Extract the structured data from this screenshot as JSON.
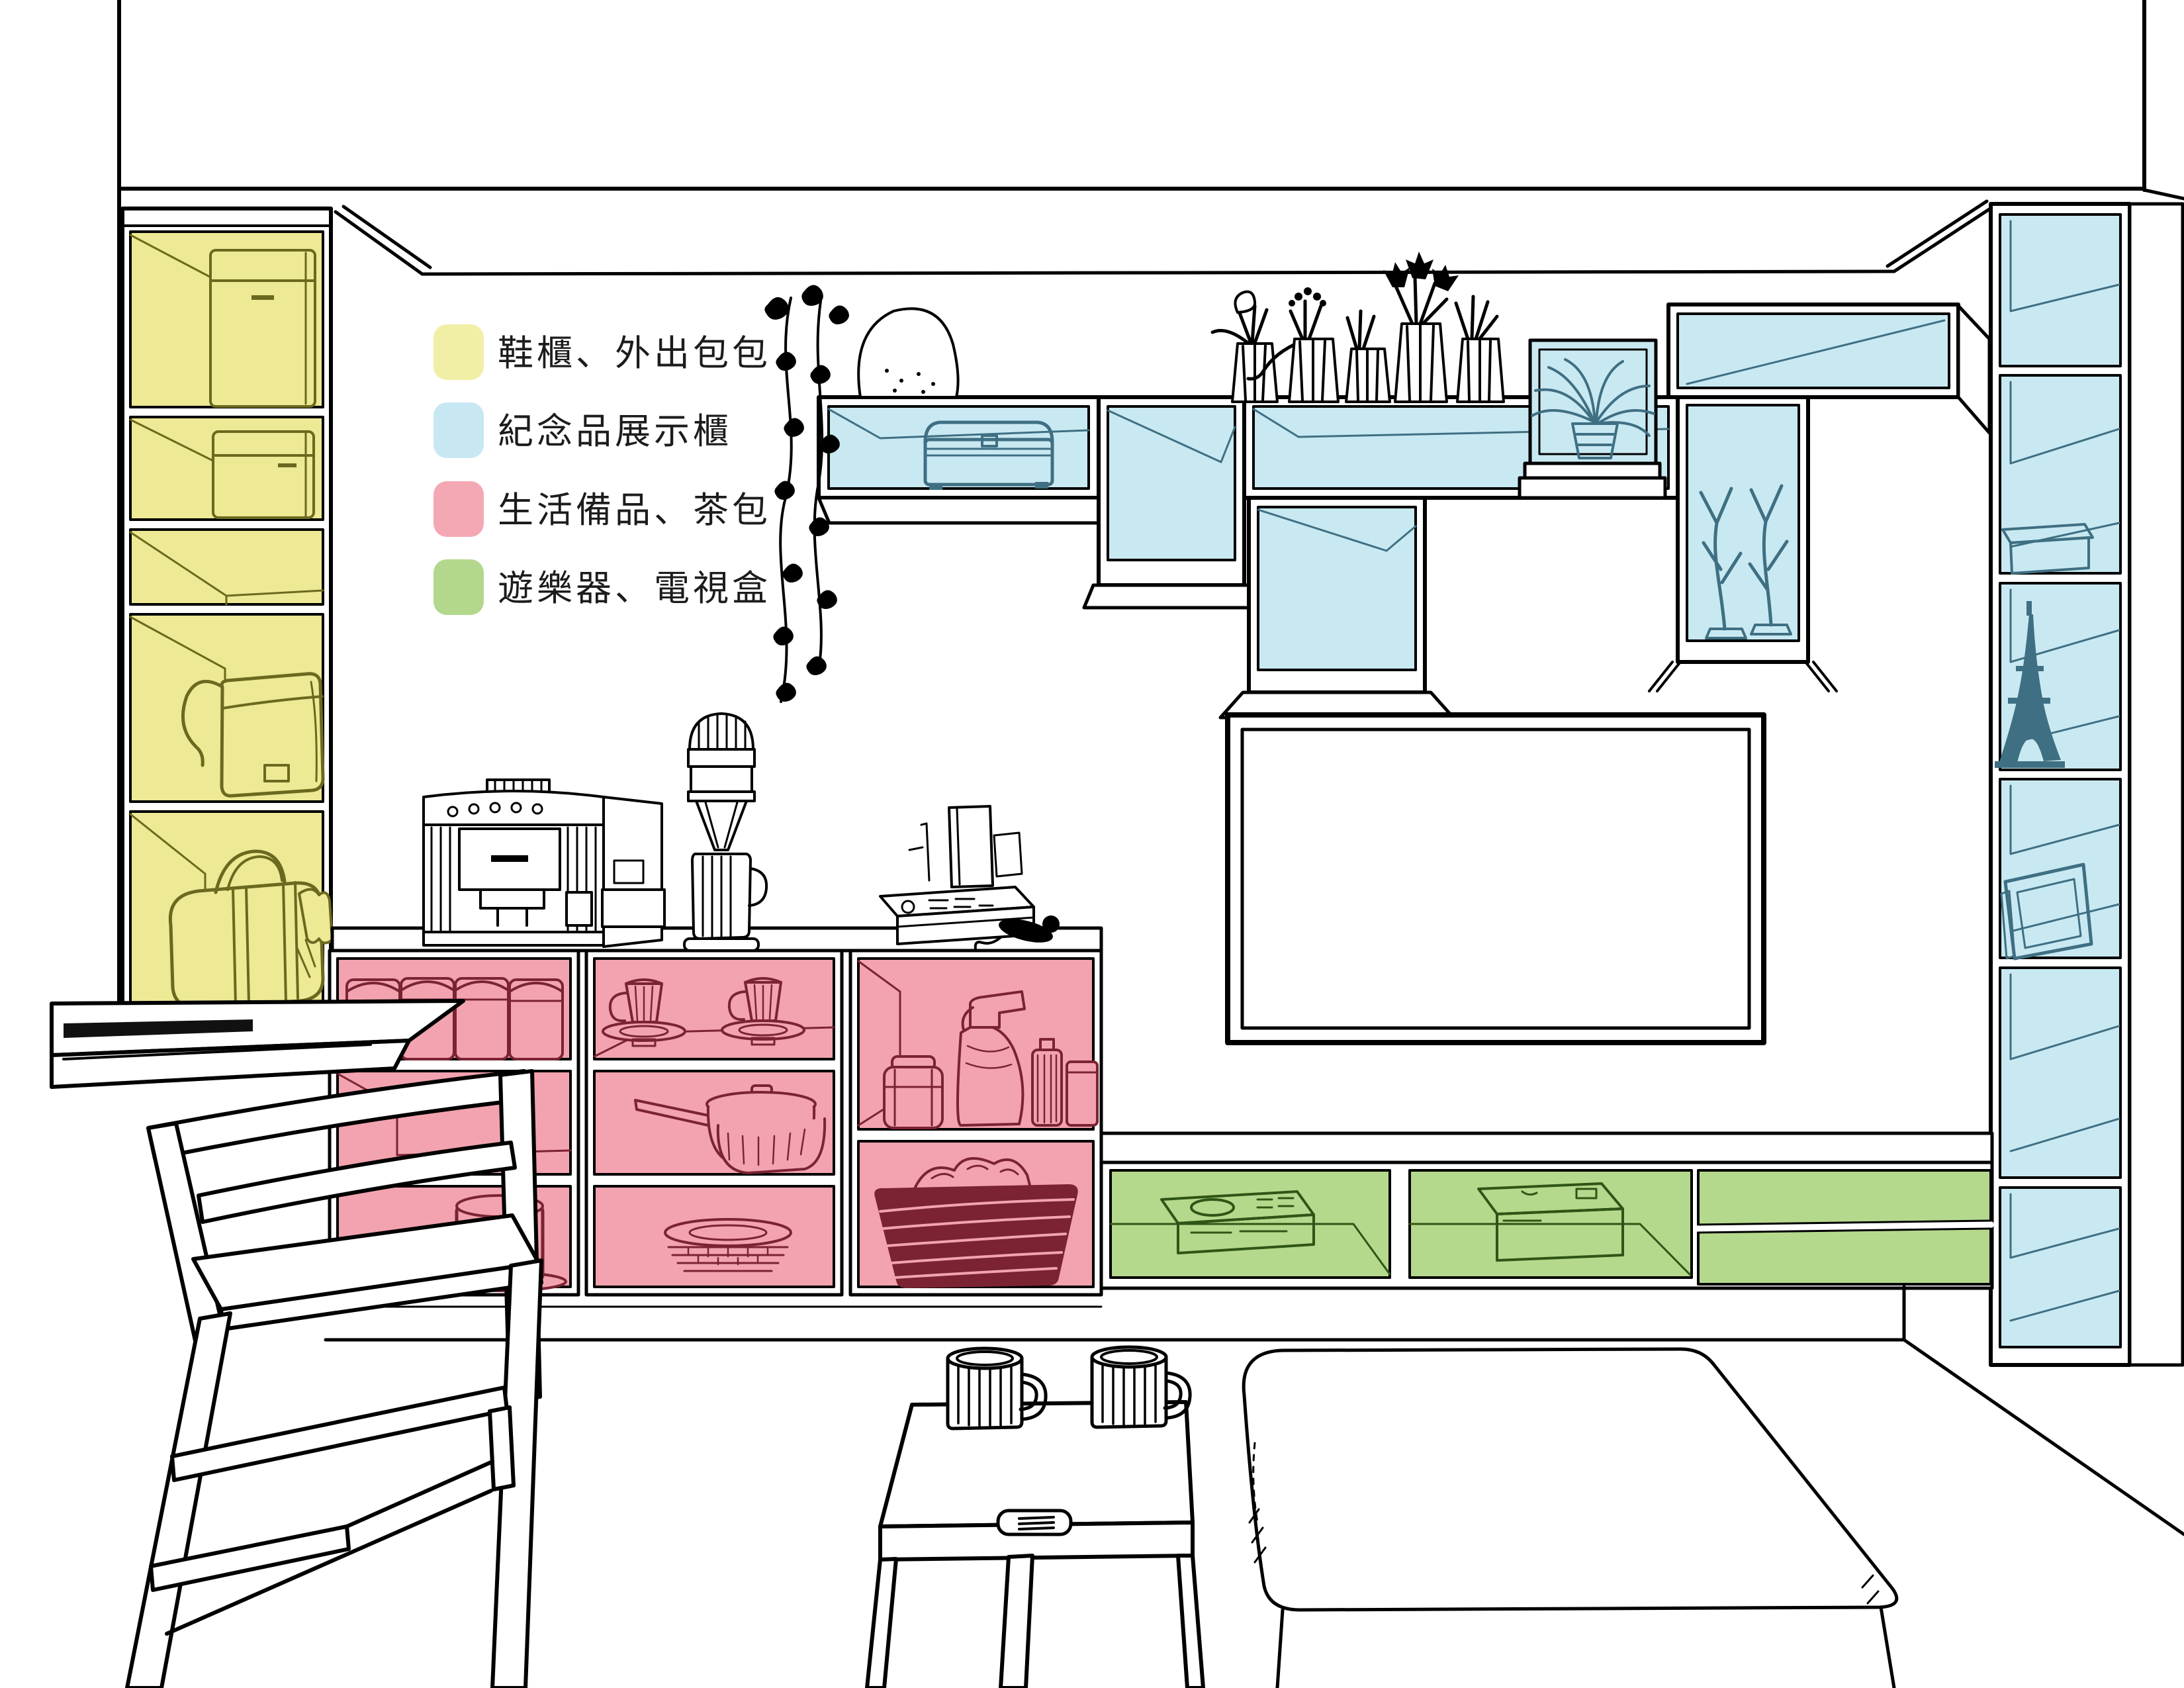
{
  "palette": {
    "ink": "#000000",
    "background": "#ffffff",
    "zone_fills": {
      "yellow": "#EDE994",
      "blue": "#C9E9F2",
      "pink": "#F2A3AF",
      "green": "#B4D98C"
    },
    "zone_lines": {
      "yellow": "#6B691F",
      "blue": "#3F6F82",
      "pink": "#7B2333",
      "green": "#2F5516"
    }
  },
  "legend": {
    "items": [
      {
        "id": "shoe-cabinet",
        "label": "鞋櫃、外出包包",
        "color": "#F1EFA6"
      },
      {
        "id": "souvenir-display",
        "label": "紀念品展示櫃",
        "color": "#C7E8F2"
      },
      {
        "id": "living-supplies",
        "label": "生活備品、茶包",
        "color": "#F4A8B4"
      },
      {
        "id": "game-tv-box",
        "label": "遊樂器、電視盒",
        "color": "#B3D88D"
      }
    ]
  },
  "zones": {
    "shoe_cabinet": {
      "label": "鞋櫃、外出包包",
      "contents": [
        "storage-box",
        "storage-box",
        "empty-shelf",
        "handbag",
        "duffel-bag"
      ]
    },
    "souvenir_display": {
      "label": "紀念品展示櫃",
      "contents": [
        "treasure-chest",
        "potted-cacti",
        "glass-terrarium-plant",
        "coral-branches",
        "eiffel-tower-model",
        "souvenir-box",
        "picture-frame"
      ]
    },
    "living_supplies": {
      "label": "生活備品、茶包",
      "contents": [
        "canister-jars",
        "teacups-and-saucers",
        "saucepan-and-basket",
        "plate-stack",
        "large-mug",
        "storage-jar",
        "spray-bottle",
        "laundry-basket"
      ]
    },
    "game_tv": {
      "label": "遊樂器、電視盒",
      "contents": [
        "game-console",
        "tv-box"
      ]
    }
  }
}
